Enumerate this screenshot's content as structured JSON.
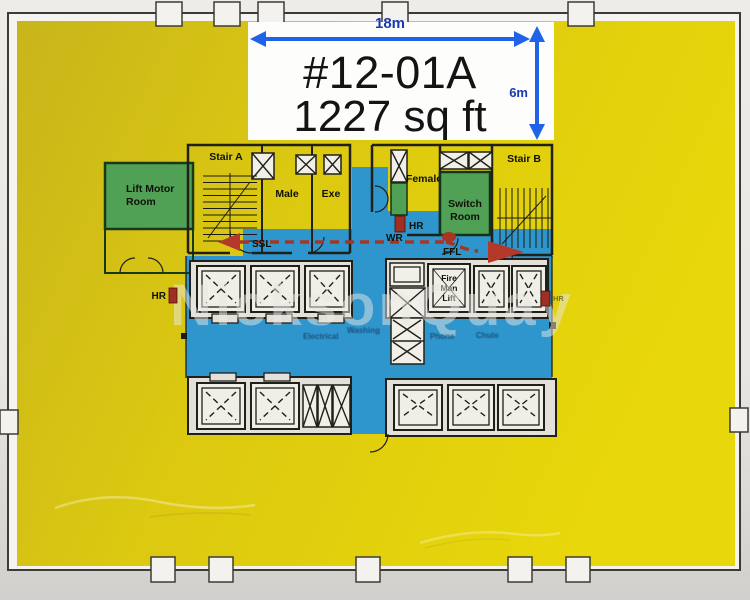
{
  "floor_plan": {
    "unit_label": {
      "unit_number": "#12-01A",
      "area": "1227 sq ft"
    },
    "dimensions": {
      "width": "18m",
      "depth": "6m"
    },
    "rooms": {
      "lift_motor_room": {
        "line1": "Lift Motor",
        "line2": "Room"
      },
      "stair_a": "Stair A",
      "stair_b": "Stair B",
      "male_toilet": "Male",
      "exe_toilet": "Exe",
      "female_toilet": "Female",
      "switch_room": {
        "line1": "Switch",
        "line2": "Room"
      },
      "fire_lift": {
        "line1": "Fire",
        "line2": "Man",
        "line3": "Lift"
      }
    },
    "markers": {
      "ssl": "SSL",
      "wr": "WR",
      "ffl": "FFL",
      "hr_left": "HR",
      "hr_center": "HR",
      "hr_right": "HR"
    },
    "riser_labels": {
      "label1": "Electrical",
      "label2": "Washing",
      "label3": "Phone",
      "label4": "Chute"
    },
    "watermark": "NicksonQuay",
    "colors": {
      "floor_highlight_yellow": "#ddca10",
      "common_area_blue": "#2e96cd",
      "plant_room_green": "#50a156",
      "escape_route_red": "#a83524",
      "dimension_arrow_blue": "#2063e8",
      "dimension_text_navy": "#1a3ab0"
    }
  }
}
